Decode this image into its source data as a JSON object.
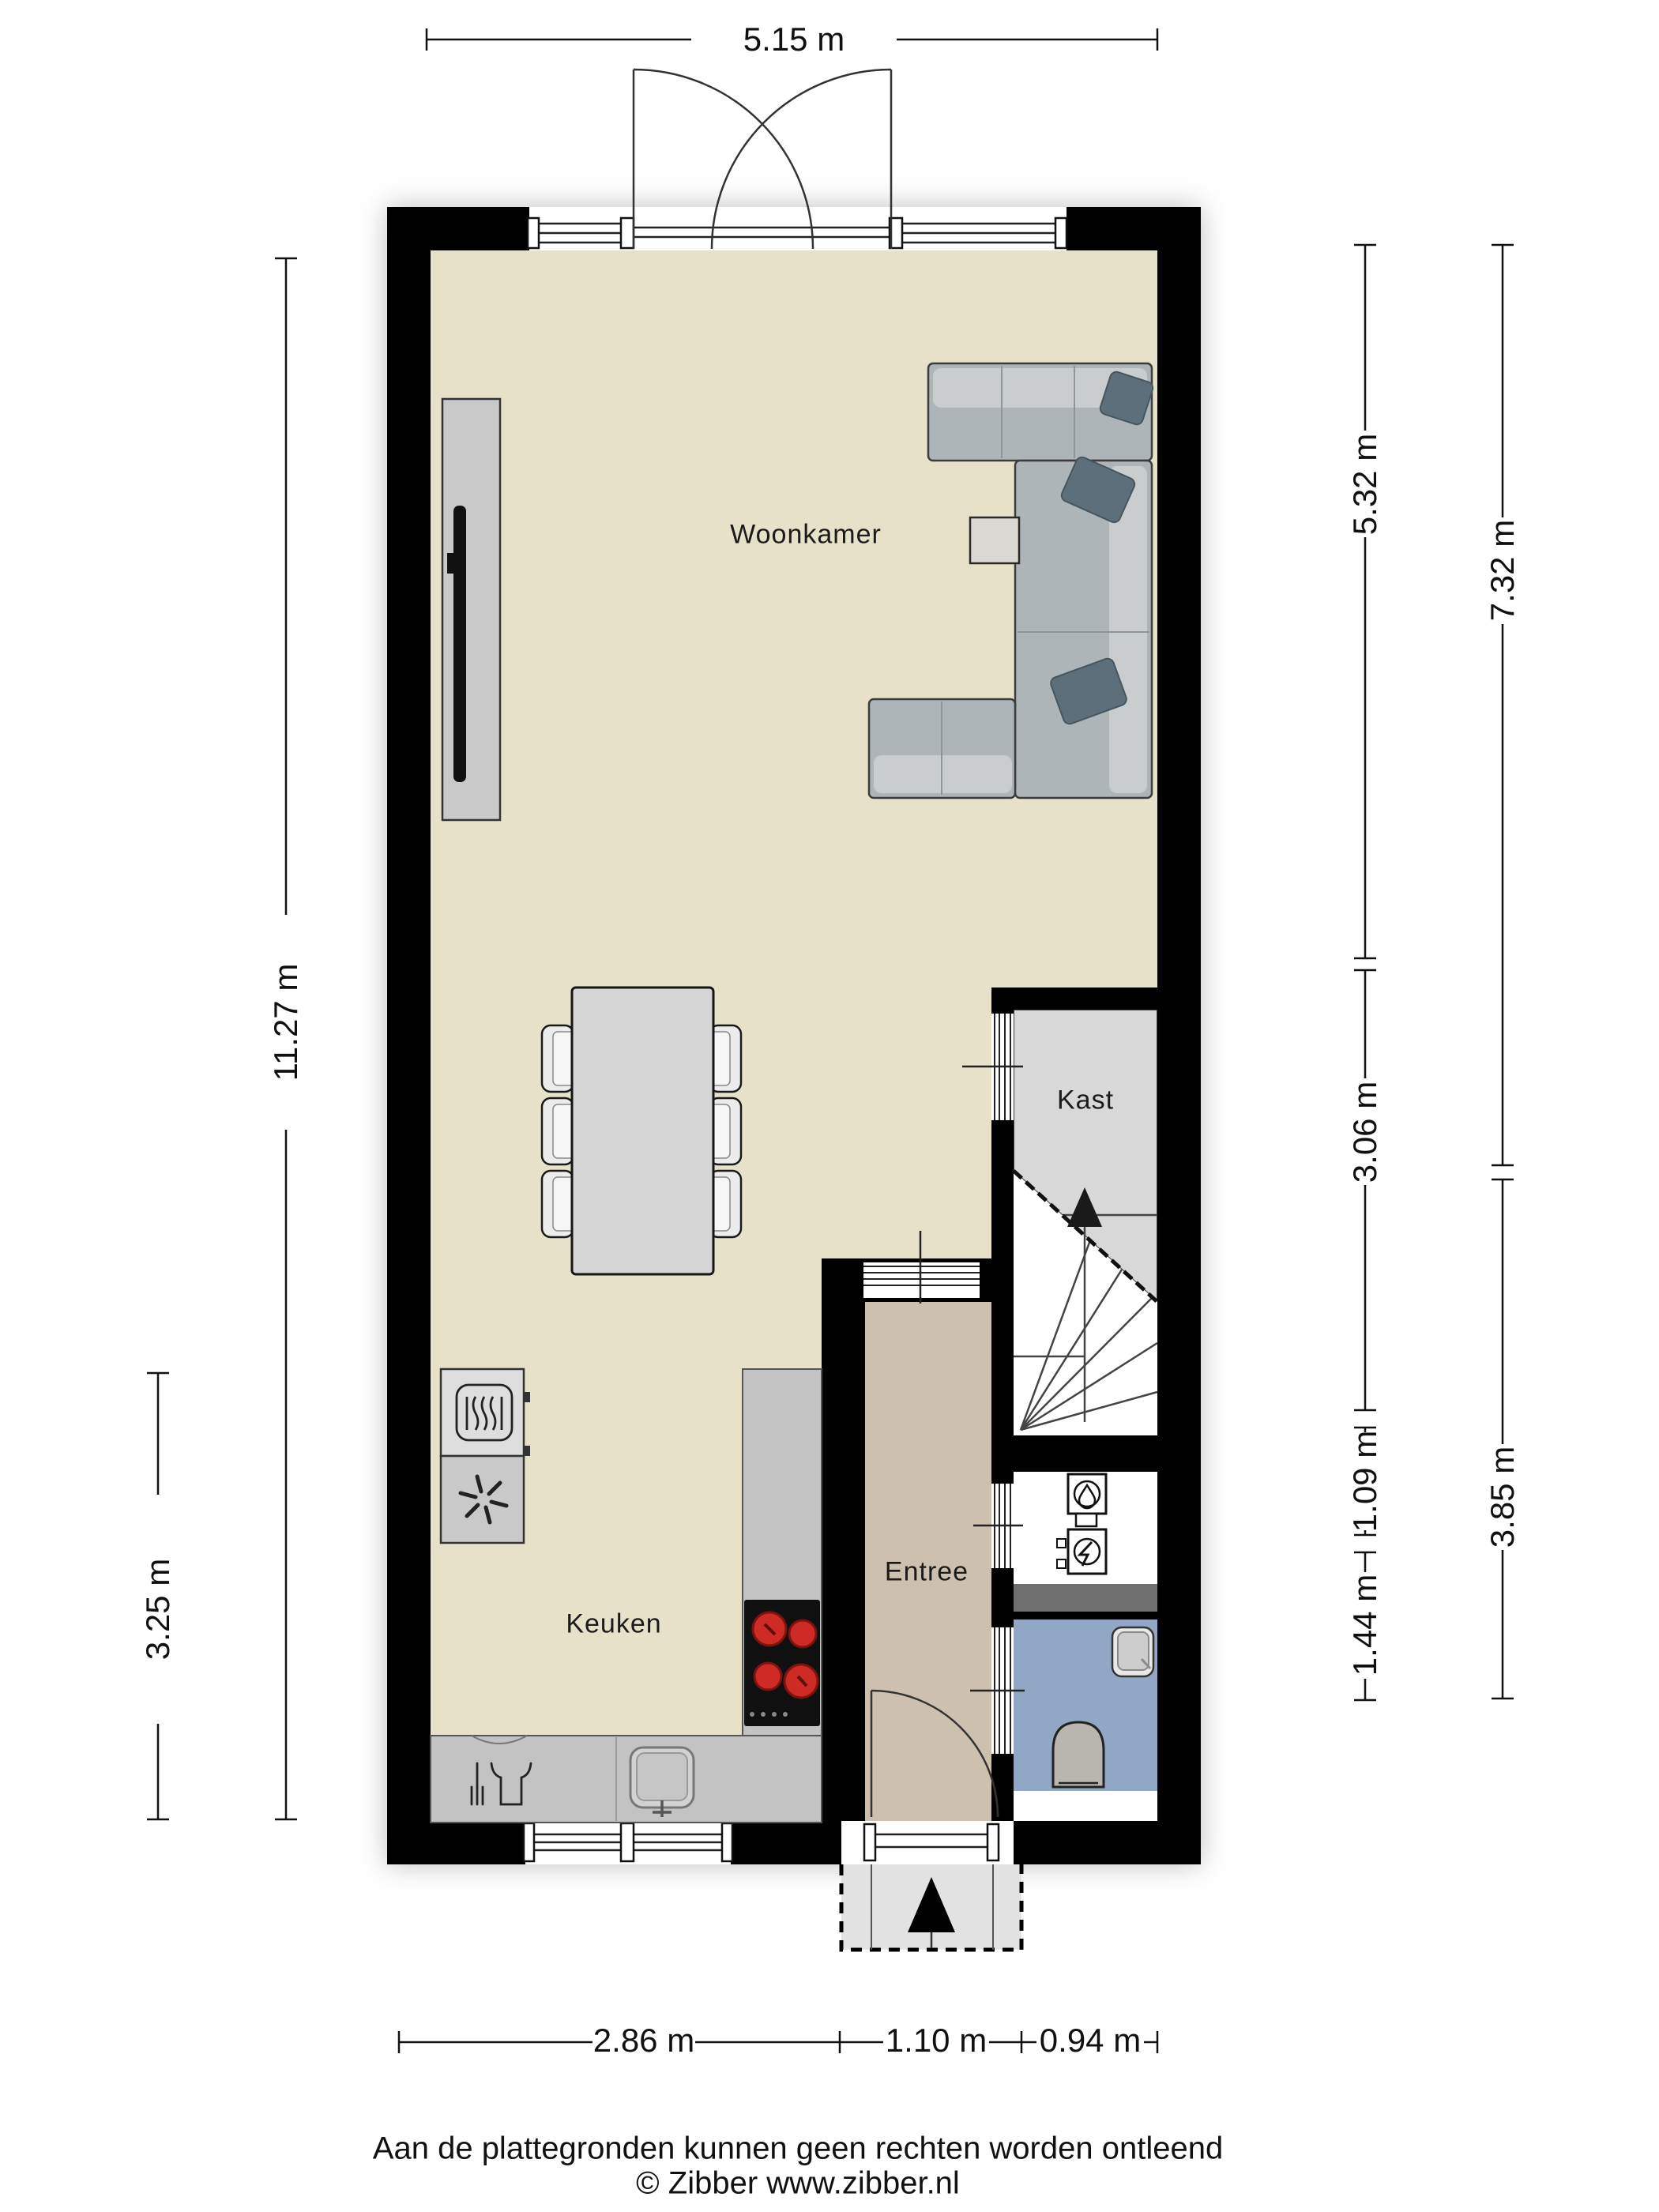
{
  "plan": {
    "rooms": {
      "woonkamer": "Woonkamer",
      "kast": "Kast",
      "entree": "Entree",
      "keuken": "Keuken"
    },
    "dimensions": {
      "top": "5.15 m",
      "left_total": "11.27 m",
      "left_kitchen": "3.25 m",
      "right_inner_living": "5.32 m",
      "right_inner_stairs": "3.06 m",
      "right_inner_closet": "1.09 m",
      "right_inner_toilet": "1.44 m",
      "right_outer_upper": "7.32 m",
      "right_outer_lower": "3.85 m",
      "bottom_kitchen": "2.86 m",
      "bottom_entrance": "1.10 m",
      "bottom_right": "0.94 m"
    },
    "footer": {
      "disclaimer": "Aan de plattegronden kunnen geen rechten worden ontleend",
      "copyright": "© Zibber www.zibber.nl"
    },
    "colors": {
      "wall": "#000000",
      "floor_beige": "#e8e1c9",
      "floor_entree": "#cdc0ae",
      "floor_kast": "#d8d8d8",
      "floor_toilet": "#92a7c6",
      "counter": "#c3c3c3",
      "appliance_light": "#dedede",
      "appliance_dark": "#c9c9c9",
      "sofa": "#aeb5b8",
      "sofa_light": "#c9cdce",
      "pillow": "#5d6f7b",
      "table": "#d5d5d5",
      "chair": "#ececec",
      "cooktop": "#101010",
      "burner": "#cf2b26",
      "porch": "#e2e2e2",
      "service_dark": "#6f6f6f",
      "tv_cabinet": "#c9c9c9",
      "line": "#111111"
    },
    "icons": [
      "oven-icon",
      "freezer-fan-icon",
      "dishwasher-icon",
      "sink-icon",
      "cooktop-burners-icon",
      "boiler-water-icon",
      "boiler-electric-icon",
      "entrance-arrow-icon",
      "stairs-up-arrow-icon"
    ]
  }
}
